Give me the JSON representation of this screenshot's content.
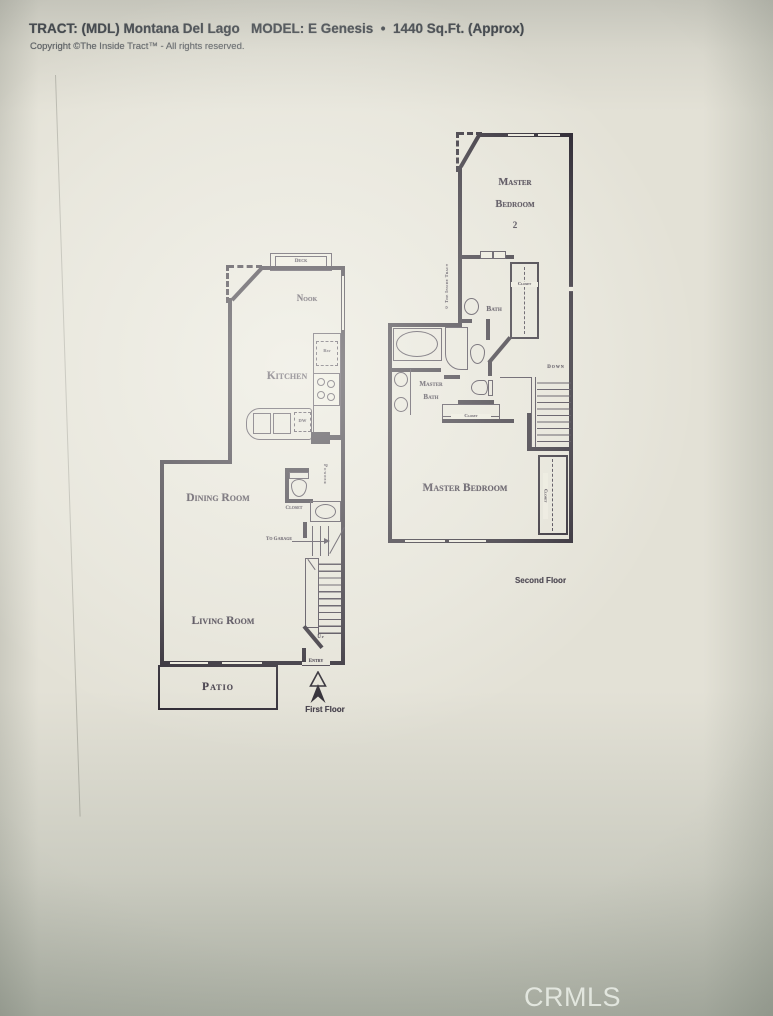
{
  "header": {
    "title": "TRACT: (MDL) Montana Del Lago   MODEL: E Genesis  •  1440 Sq.Ft. (Approx)",
    "copyright": "Copyright ©The Inside Tract™ - All rights reserved."
  },
  "first_floor": {
    "caption": "First Floor",
    "deck": "Deck",
    "nook": "Nook",
    "kitchen": "Kitchen",
    "dining_room": "Dining Room",
    "living_room": "Living Room",
    "patio": "Patio",
    "ref": "Ref",
    "dw": "DW",
    "powder": "Powder",
    "closet": "Closet",
    "to_garage": "To Garage",
    "up": "Up",
    "entry": "Entry"
  },
  "second_floor": {
    "caption": "Second Floor",
    "credit": "© The Inside Tract",
    "master_bedroom_2": {
      "line1": "Master",
      "line2": "Bedroom",
      "line3": "2"
    },
    "bath": "Bath",
    "master_bath": {
      "line1": "Master",
      "line2": "Bath"
    },
    "master_bedroom": "Master Bedroom",
    "closet": "Closet",
    "down": "Down"
  },
  "watermark": "CRMLS",
  "colors": {
    "wall": "#241f2a",
    "paper": "#eae8dc",
    "background": "#e3e1d6",
    "header_text": "#3a3f47",
    "watermark_text": "#f0f4ee"
  }
}
